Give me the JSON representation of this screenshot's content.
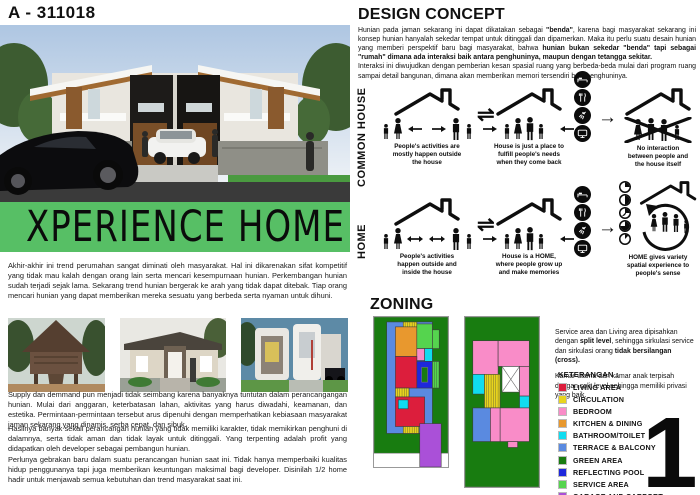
{
  "board": {
    "id_label": "A - 311018",
    "page_number": "1"
  },
  "left": {
    "banner": {
      "title": "XPERIENCE HOME",
      "bg_color": "#57bf65"
    },
    "intro_paragraph": "Akhir-akhir ini trend perumahan sangat diminati oleh masyarakat. Hal ini dikarenakan sifat kompetitif yang tidak mau kalah dengan orang lain serta mencari kesempurnaan hunian. Perkembangan hunian sudah terjadi sejak lama. Sekarang trend hunian bergerak ke arah yang tidak dapat ditebak. Tiap orang mencari hunian yang dapat memberikan mereka sesuatu yang berbeda serta nyaman untuk dihuni.",
    "paragraphs": [
      "Supply dan demmand pun menjadi tidak seimbang karena banyaknya tuntutan dalam perancangangan hunian. Mulai dari anggaran, keterbatasan lahan, aktivitas yang harus diwadahi, keamanan, dan estetika. Permintaan-permintaan tersebut arus dipenuhi dengan memperhatikan kebiasaan masyarakat jaman sekarang yang dinamis, serba cepat, dan sibuk.",
      "Hasilnya banyak sekali perancangan hunian yang tidak memiliki karakter, tidak memikirkan penghuni di dalamnya, serta tidak aman dan tidak layak untuk ditinggali. Yang terpenting adalah profit yang didapatkan oleh developer sebagai pembangun hunian.",
      "Perlunya gebrakan baru dalam suatu perancangan hunian saat ini. Tidak hanya memperbaiki kualitas hidup penggunanya tapi juga memberikan keuntungan maksimal bagi developer. Disinilah 1/2 home hadir untuk menjawab semua kebutuhan dan trend masyarakat saat ini."
    ]
  },
  "design_concept": {
    "title": "DESIGN CONCEPT",
    "intro1": [
      {
        "t": "Hunian pada jaman sekarang ini dapat dikatakan sebagai ",
        "b": false
      },
      {
        "t": "\"benda\"",
        "b": true
      },
      {
        "t": ", karena bagi masyarakat sekarang ini konsep hunian hanyalah sekedar tempat untuk ditinggali dan dipamerkan. Maka itu perlu suatu desain hunian yang memberi perspektif baru bagi masyarakat, bahwa ",
        "b": false
      },
      {
        "t": "hunian bukan sekedar \"benda\" tapi sebagai \"rumah\" dimana ada interaksi baik antara penghuninya, maupun dengan tetangga sekitar.",
        "b": true
      }
    ],
    "intro2": [
      {
        "t": "Interaksi ini diwujudkan dengan pemberian kesan spasial ruang yang berbeda-beda mulai dari program ruang sampai detail bangunan, dimana akan memberikan memori tersendiri bagi penghuninya.",
        "b": false
      }
    ],
    "relation_arrow": "⇌",
    "forward_arrow": "→",
    "needs_icons": [
      "bed",
      "utensils",
      "shower",
      "tv"
    ],
    "rows": [
      {
        "label": "COMMON HOUSE",
        "items": [
          {
            "caption": "People's activities are\nmostly happen outside\nthe house"
          },
          {
            "caption": "House is just a place to\nfulfill people's needs\nwhen they come back"
          },
          {
            "caption": "No interaction\nbetween people and\nthe house itself"
          }
        ]
      },
      {
        "label": "HOME",
        "items": [
          {
            "caption": "People's activities\nhappen outside and\ninside the house"
          },
          {
            "caption": "House is a HOME,\nwhere people grow up\nand make memories"
          },
          {
            "caption": "HOME gives variety\nspatial experience to\npeople's sense"
          }
        ]
      }
    ]
  },
  "zoning": {
    "title": "ZONING",
    "note1": [
      {
        "t": "Service area dan Living area dipisahkan dengan ",
        "b": false
      },
      {
        "t": "split level",
        "b": true
      },
      {
        "t": ", sehingga sirkulasi service dan sirkulasi orang ",
        "b": false
      },
      {
        "t": "tidak bersilangan (cross).",
        "b": true
      }
    ],
    "note2": [
      {
        "t": "Kamar utama dan kamar anak terpisah dengan split level sehingga memiliki privasi yang baik.",
        "b": false
      }
    ],
    "legend": {
      "title": "KETERANGAN :",
      "items": [
        {
          "key": "living",
          "label": "LIVING AREA",
          "color": "#dc1e3c"
        },
        {
          "key": "circulation",
          "label": "CIRCULATION",
          "color": "#e8d41e"
        },
        {
          "key": "bedroom",
          "label": "BEDROOM",
          "color": "#f98cc8"
        },
        {
          "key": "kitchen",
          "label": "KITCHEN & DINING",
          "color": "#e8982e"
        },
        {
          "key": "bathroom",
          "label": "BATHROOM/TOILET",
          "color": "#10dcf0"
        },
        {
          "key": "terrace",
          "label": "TERRACE & BALCONY",
          "color": "#5a8ae0"
        },
        {
          "key": "green",
          "label": "GREEN AREA",
          "color": "#187c10"
        },
        {
          "key": "pool",
          "label": "REFLECTING POOL",
          "color": "#1e28dc"
        },
        {
          "key": "service",
          "label": "SERVICE AREA",
          "color": "#55d44e"
        },
        {
          "key": "garage",
          "label": "GARAGE AND CARPORT",
          "color": "#aa50d8"
        }
      ]
    },
    "plans": [
      {
        "name": "ground-floor-plan",
        "viewBox": "0 0 76 152",
        "rects": [
          {
            "c": "green",
            "x": 0,
            "y": 0,
            "w": 76,
            "h": 138
          },
          {
            "c": "terrace",
            "x": 13,
            "y": 5,
            "w": 47,
            "h": 113
          },
          {
            "c": "circulation",
            "x": 30,
            "y": 5,
            "w": 14,
            "h": 7,
            "hatch": true
          },
          {
            "c": "kitchen",
            "x": 22,
            "y": 10,
            "w": 22,
            "h": 30
          },
          {
            "c": "service",
            "x": 44,
            "y": 7,
            "w": 16,
            "h": 25
          },
          {
            "c": "service",
            "x": 60,
            "y": 13,
            "w": 7,
            "h": 19
          },
          {
            "c": "bedroom",
            "x": 44,
            "y": 32,
            "w": 8,
            "h": 12
          },
          {
            "c": "bathroom",
            "x": 52,
            "y": 32,
            "w": 8,
            "h": 13
          },
          {
            "c": "living",
            "x": 22,
            "y": 40,
            "w": 22,
            "h": 32
          },
          {
            "c": "pool",
            "x": 44,
            "y": 45,
            "w": 16,
            "h": 27
          },
          {
            "c": "green",
            "x": 49,
            "y": 51,
            "w": 6,
            "h": 15
          },
          {
            "c": "service",
            "x": 60,
            "y": 45,
            "w": 7,
            "h": 27,
            "hatch": true
          },
          {
            "c": "circulation",
            "x": 22,
            "y": 72,
            "w": 14,
            "h": 9,
            "hatch": true
          },
          {
            "c": "living",
            "x": 22,
            "y": 81,
            "w": 30,
            "h": 30
          },
          {
            "c": "bathroom",
            "x": 25,
            "y": 84,
            "w": 10,
            "h": 9
          },
          {
            "c": "circulation",
            "x": 30,
            "y": 111,
            "w": 16,
            "h": 7,
            "hatch": true
          },
          {
            "c": "garage",
            "x": 47,
            "y": 108,
            "w": 22,
            "h": 44
          }
        ]
      },
      {
        "name": "upper-floor-plan",
        "viewBox": "0 0 76 172",
        "rects": [
          {
            "c": "green",
            "x": 0,
            "y": 0,
            "w": 76,
            "h": 172
          },
          {
            "c": "bedroom",
            "x": 8,
            "y": 24,
            "w": 26,
            "h": 34
          },
          {
            "c": "bedroom",
            "x": 34,
            "y": 24,
            "w": 32,
            "h": 26
          },
          {
            "c": "void",
            "x": 38,
            "y": 50,
            "w": 18,
            "h": 26
          },
          {
            "c": "bedroom",
            "x": 56,
            "y": 50,
            "w": 10,
            "h": 30
          },
          {
            "c": "bathroom",
            "x": 8,
            "y": 58,
            "w": 12,
            "h": 20
          },
          {
            "c": "circulation",
            "x": 20,
            "y": 58,
            "w": 16,
            "h": 34,
            "hatch": true
          },
          {
            "c": "bathroom",
            "x": 56,
            "y": 80,
            "w": 10,
            "h": 12
          },
          {
            "c": "bedroom",
            "x": 36,
            "y": 92,
            "w": 30,
            "h": 34
          },
          {
            "c": "bedroom",
            "x": 26,
            "y": 92,
            "w": 10,
            "h": 34
          },
          {
            "c": "terrace",
            "x": 8,
            "y": 92,
            "w": 18,
            "h": 34
          },
          {
            "c": "bedroom",
            "x": 44,
            "y": 126,
            "w": 10,
            "h": 6
          }
        ]
      }
    ]
  }
}
